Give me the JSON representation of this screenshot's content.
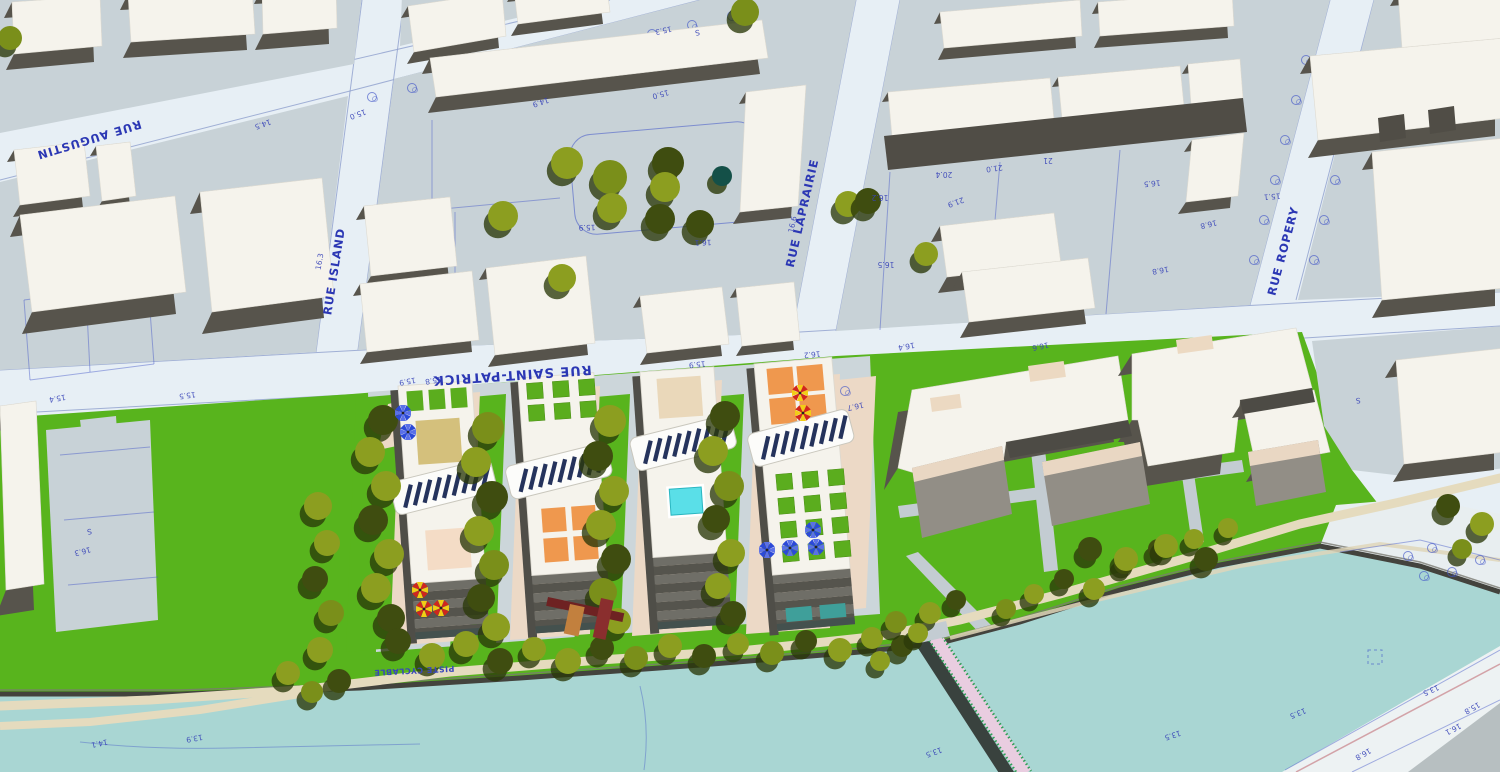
{
  "scene": {
    "type": "3d-architectural-site-plan",
    "features": [
      "city blocks",
      "residential towers with roof gardens and solar panels",
      "canal",
      "pedestrian bridge",
      "waterfront park",
      "bike path"
    ]
  },
  "streets": {
    "augustin": "RUE AUGUSTIN",
    "island": "RUE ISLAND",
    "saint_patrick": "RUE SAINT-PATRICK",
    "laprairie": "RUE LAPRAIRIE",
    "ropery": "RUE ROPERY"
  },
  "paths": {
    "bike_path_label": "PISTE CYCLABLE"
  },
  "spot_elevations": [
    {
      "v": "14.5",
      "x": 262,
      "y": 122,
      "r": 160
    },
    {
      "v": "15.4",
      "x": 57,
      "y": 396,
      "r": 170
    },
    {
      "v": "15.5",
      "x": 187,
      "y": 393,
      "r": 172
    },
    {
      "v": "15.8",
      "x": 433,
      "y": 378,
      "r": 170
    },
    {
      "v": "15.9",
      "x": 407,
      "y": 379,
      "r": 170
    },
    {
      "v": "15.9",
      "x": 697,
      "y": 362,
      "r": 174
    },
    {
      "v": "16.2",
      "x": 812,
      "y": 352,
      "r": 174
    },
    {
      "v": "16.3",
      "x": 322,
      "y": 262,
      "r": -80
    },
    {
      "v": "16.6",
      "x": 795,
      "y": 225,
      "r": -78
    },
    {
      "v": "15.0",
      "x": 357,
      "y": 112,
      "r": 160
    },
    {
      "v": "14.9",
      "x": 540,
      "y": 100,
      "r": 162
    },
    {
      "v": "15.0",
      "x": 660,
      "y": 92,
      "r": 164
    },
    {
      "v": "15.3",
      "x": 663,
      "y": 28,
      "r": 168
    },
    {
      "v": "S",
      "x": 697,
      "y": 30,
      "r": 170
    },
    {
      "v": "15.9",
      "x": 587,
      "y": 225,
      "r": 178
    },
    {
      "v": "16.1",
      "x": 703,
      "y": 240,
      "r": 178
    },
    {
      "v": "16.2",
      "x": 880,
      "y": 195,
      "r": 180
    },
    {
      "v": "16.5",
      "x": 886,
      "y": 262,
      "r": 180
    },
    {
      "v": "20.4",
      "x": 944,
      "y": 172,
      "r": 180
    },
    {
      "v": "21.9",
      "x": 955,
      "y": 200,
      "r": 160
    },
    {
      "v": "21.0",
      "x": 994,
      "y": 166,
      "r": 172
    },
    {
      "v": "21",
      "x": 1048,
      "y": 158,
      "r": 180
    },
    {
      "v": "16.5",
      "x": 1152,
      "y": 181,
      "r": 174
    },
    {
      "v": "16.8",
      "x": 1208,
      "y": 222,
      "r": 166
    },
    {
      "v": "16.8",
      "x": 1160,
      "y": 268,
      "r": 170
    },
    {
      "v": "15.1",
      "x": 1272,
      "y": 194,
      "r": 175
    },
    {
      "v": "16.4",
      "x": 906,
      "y": 344,
      "r": 170
    },
    {
      "v": "16.6",
      "x": 1040,
      "y": 344,
      "r": 168
    },
    {
      "v": "16.7",
      "x": 855,
      "y": 404,
      "r": 168
    },
    {
      "v": "S",
      "x": 89,
      "y": 529,
      "r": 170
    },
    {
      "v": "16.3",
      "x": 82,
      "y": 549,
      "r": 165
    },
    {
      "v": "S",
      "x": 1358,
      "y": 398,
      "r": 175
    },
    {
      "v": "14.1",
      "x": 99,
      "y": 741,
      "r": 168
    },
    {
      "v": "13.9",
      "x": 194,
      "y": 736,
      "r": 170
    },
    {
      "v": "13.5",
      "x": 933,
      "y": 750,
      "r": 160
    },
    {
      "v": "13.5",
      "x": 1172,
      "y": 733,
      "r": 162
    },
    {
      "v": "13.5",
      "x": 1297,
      "y": 711,
      "r": 158
    },
    {
      "v": "13.5",
      "x": 1430,
      "y": 688,
      "r": 156
    },
    {
      "v": "15.8",
      "x": 1471,
      "y": 706,
      "r": 150
    },
    {
      "v": "16.1",
      "x": 1452,
      "y": 727,
      "r": 152
    },
    {
      "v": "16.8",
      "x": 1362,
      "y": 752,
      "r": 150
    }
  ],
  "palette": {
    "water": "#a9d6d3",
    "grass": "#58b41d",
    "tree_olive": "#8c9e20",
    "tree_dark": "#3f4d10",
    "street": "#e7eff5",
    "block_ground": "#c8d2d7",
    "roof_white": "#f5f3ec",
    "wall_dark": "#57544c",
    "cad_blue": "#3946bb",
    "path_beige": "#e5dbbe",
    "bridge_deck": "#e9cde0",
    "bridge_truss": "#2f9e57",
    "solar_panel": "#25335c",
    "roof_garden_green": "#5bad1e",
    "terrace_orange": "#ef984e",
    "pool_cyan": "#5adfe8",
    "khaki_deck": "#d4c07c",
    "pink_deck": "#f4dcc6",
    "umbrella_red": "#d0261c",
    "umbrella_yellow": "#f2ce15",
    "umbrella_blue": "#2b49d8",
    "sculpture_maroon": "#8a2e2e"
  }
}
